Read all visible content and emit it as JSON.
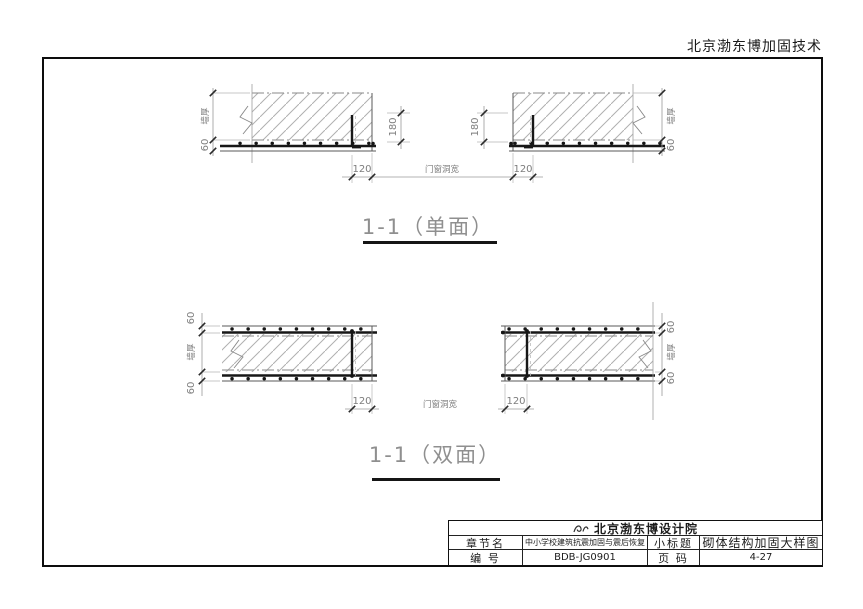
{
  "company_header": "北京渤东博加固技术",
  "dims": {
    "d60": "60",
    "d120": "120",
    "d180": "180",
    "wall_thickness": "墙厚",
    "opening_width": "门窗洞宽"
  },
  "figures": {
    "single_title": "1-1（单面）",
    "double_title": "1-1（双面）"
  },
  "title_block": {
    "institute": "北京渤东博设计院",
    "row1": {
      "label_a": "章节名",
      "value_a": "中小学校建筑抗震加固与震后恢复",
      "label_b": "小标题",
      "value_b": "砌体结构加固大样图"
    },
    "row2": {
      "label_a": "编 号",
      "value_a": "BDB-JG0901",
      "label_b": "页 码",
      "value_b": "4-27"
    }
  }
}
